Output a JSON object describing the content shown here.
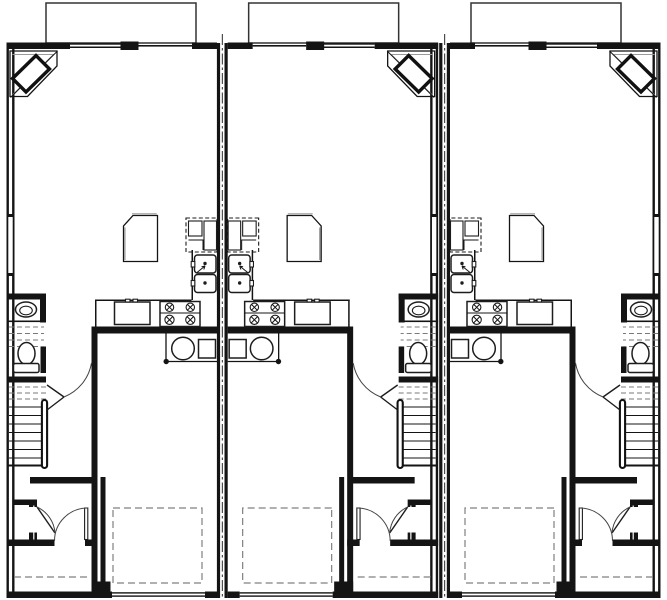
{
  "document": {
    "type": "architectural-floor-plan",
    "title": "Triplex town house plan - main floor",
    "unit_count": 3,
    "canvas": {
      "width": 667,
      "height": 600
    }
  },
  "colors": {
    "background": "#ffffff",
    "wall": "#141414",
    "light_gray": "#9a9a9a",
    "dashed_gray": "#808080"
  },
  "units": [
    {
      "id": "unit-1",
      "label": "left unit",
      "mirrored": false,
      "transform": "translate(0,0)"
    },
    {
      "id": "unit-2",
      "label": "middle unit",
      "mirrored": true,
      "transform": "translate(444.66,0) scale(-1,1)"
    },
    {
      "id": "unit-3",
      "label": "right unit",
      "mirrored": true,
      "transform": "translate(667,0) scale(-1,1)"
    }
  ],
  "party_walls": [
    {
      "id": "party-wall-1",
      "centerline_x": 222.33
    },
    {
      "id": "party-wall-2",
      "centerline_x": 444.66
    }
  ],
  "per_unit_symbols": [
    "bay-window",
    "corner-fireplace",
    "pantry",
    "refrigerator",
    "upper-cabinets",
    "double-kitchen-sink",
    "dishwasher",
    "range-4-burners",
    "kitchen-counter",
    "water-heater",
    "furnace",
    "powder-sink",
    "toilet",
    "stairs",
    "handrail",
    "hall-door",
    "entry-closet",
    "closet-door",
    "front-door",
    "porch-steps",
    "garage",
    "car-space",
    "garage-door",
    "window"
  ]
}
